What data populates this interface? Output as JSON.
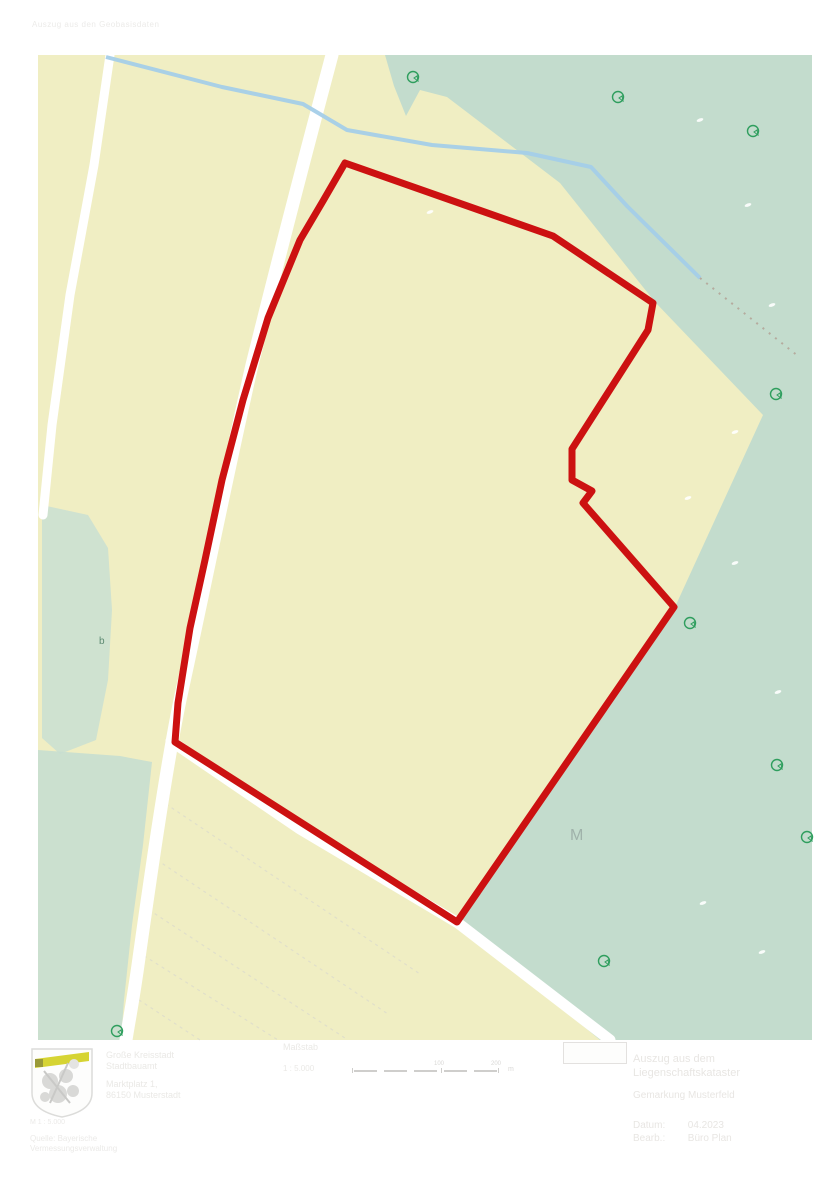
{
  "page": {
    "faint_header": "Auszug aus den Geobasisdaten"
  },
  "map": {
    "colors": {
      "field": "#f0eec3",
      "forest": "#c3dccd",
      "stream": "#a4cee8",
      "boundary_red": "#cc1111",
      "road_white": "#ffffff",
      "symbol_green": "#2f9e5e",
      "label_gray": "#9fb2aa"
    },
    "shapes": {
      "field_rect": "38,55 812,55 812,1040 38,1040",
      "forest_main": "385,55 394,86 406,116 420,90 447,97 560,183 655,302 763,415 675,607 457,922 600,1040 812,1040 812,55",
      "forest_left_strip": "42,505 88,515 108,548 112,610 108,680 96,740 60,754 42,738",
      "forest_bottom_left": "38,750 120,756 152,762 143,845 132,925 124,1000 121,1040 38,1040",
      "boundary": "345,163 553,236 653,303 648,330 572,449 572,480 592,491 583,503 674,607 457,922 175,742 178,703 190,628 205,560 222,480 243,400 268,318 300,240 323,201",
      "road_main": "M332,55 C312,130 283,240 252,365 C228,470 203,595 180,700 C166,768 150,880 139,958 C133,1002 128,1026 126,1040",
      "road_left": "M110,55 L94,165 L70,295 L52,425 L43,515",
      "road_bottom": "M171,741 L300,829 L458,923 L610,1040",
      "stream": "M106,57 L222,87 L303,104 L347,130 L432,145 L527,153 L591,167 L627,206 L700,278",
      "speckle_track": "M700,278 L798,356",
      "field_lines": "M160,800 L420,974 M151,856 L388,1014 M143,906 L348,1040 M138,952 L278,1040 M133,996 L200,1040"
    },
    "tree_symbols": [
      "translate(413,77)",
      "translate(618,97)",
      "translate(753,131)",
      "translate(776,394)",
      "translate(690,623)",
      "translate(777,765)",
      "translate(807,837)",
      "translate(604,961)",
      "translate(117,1031)"
    ],
    "white_specks": [
      "translate(700,120)",
      "translate(748,205)",
      "translate(772,305)",
      "translate(688,498)",
      "translate(735,563)",
      "translate(778,692)",
      "translate(703,903)",
      "translate(762,952)",
      "translate(735,432)",
      "translate(430,212)"
    ],
    "labels": {
      "m_label": "M",
      "b_label": "b"
    }
  },
  "footer": {
    "crest": {
      "band_color": "#d6d433",
      "outline_color": "#dcdcda"
    },
    "issuer": {
      "line1": "Große Kreisstadt",
      "line2": "Stadtbauamt",
      "line3": "Marktplatz 1,",
      "line4": "86150 Musterstadt"
    },
    "note": {
      "line1": "M 1 : 5.000",
      "line2": "Quelle: Bayerische",
      "line3": "Vermessungsverwaltung"
    },
    "scale": {
      "label": "Maßstab",
      "value": "1 : 5.000",
      "ticks": [
        "100",
        "200"
      ],
      "unit": "m"
    },
    "project": {
      "title_line1": "Auszug aus dem",
      "title_line2": "Liegenschaftskataster",
      "subtitle": "Gemarkung Musterfeld",
      "meta1_label": "Datum:",
      "meta1_value": "04.2023",
      "meta2_label": "Bearb.:",
      "meta2_value": "Büro Plan"
    }
  }
}
